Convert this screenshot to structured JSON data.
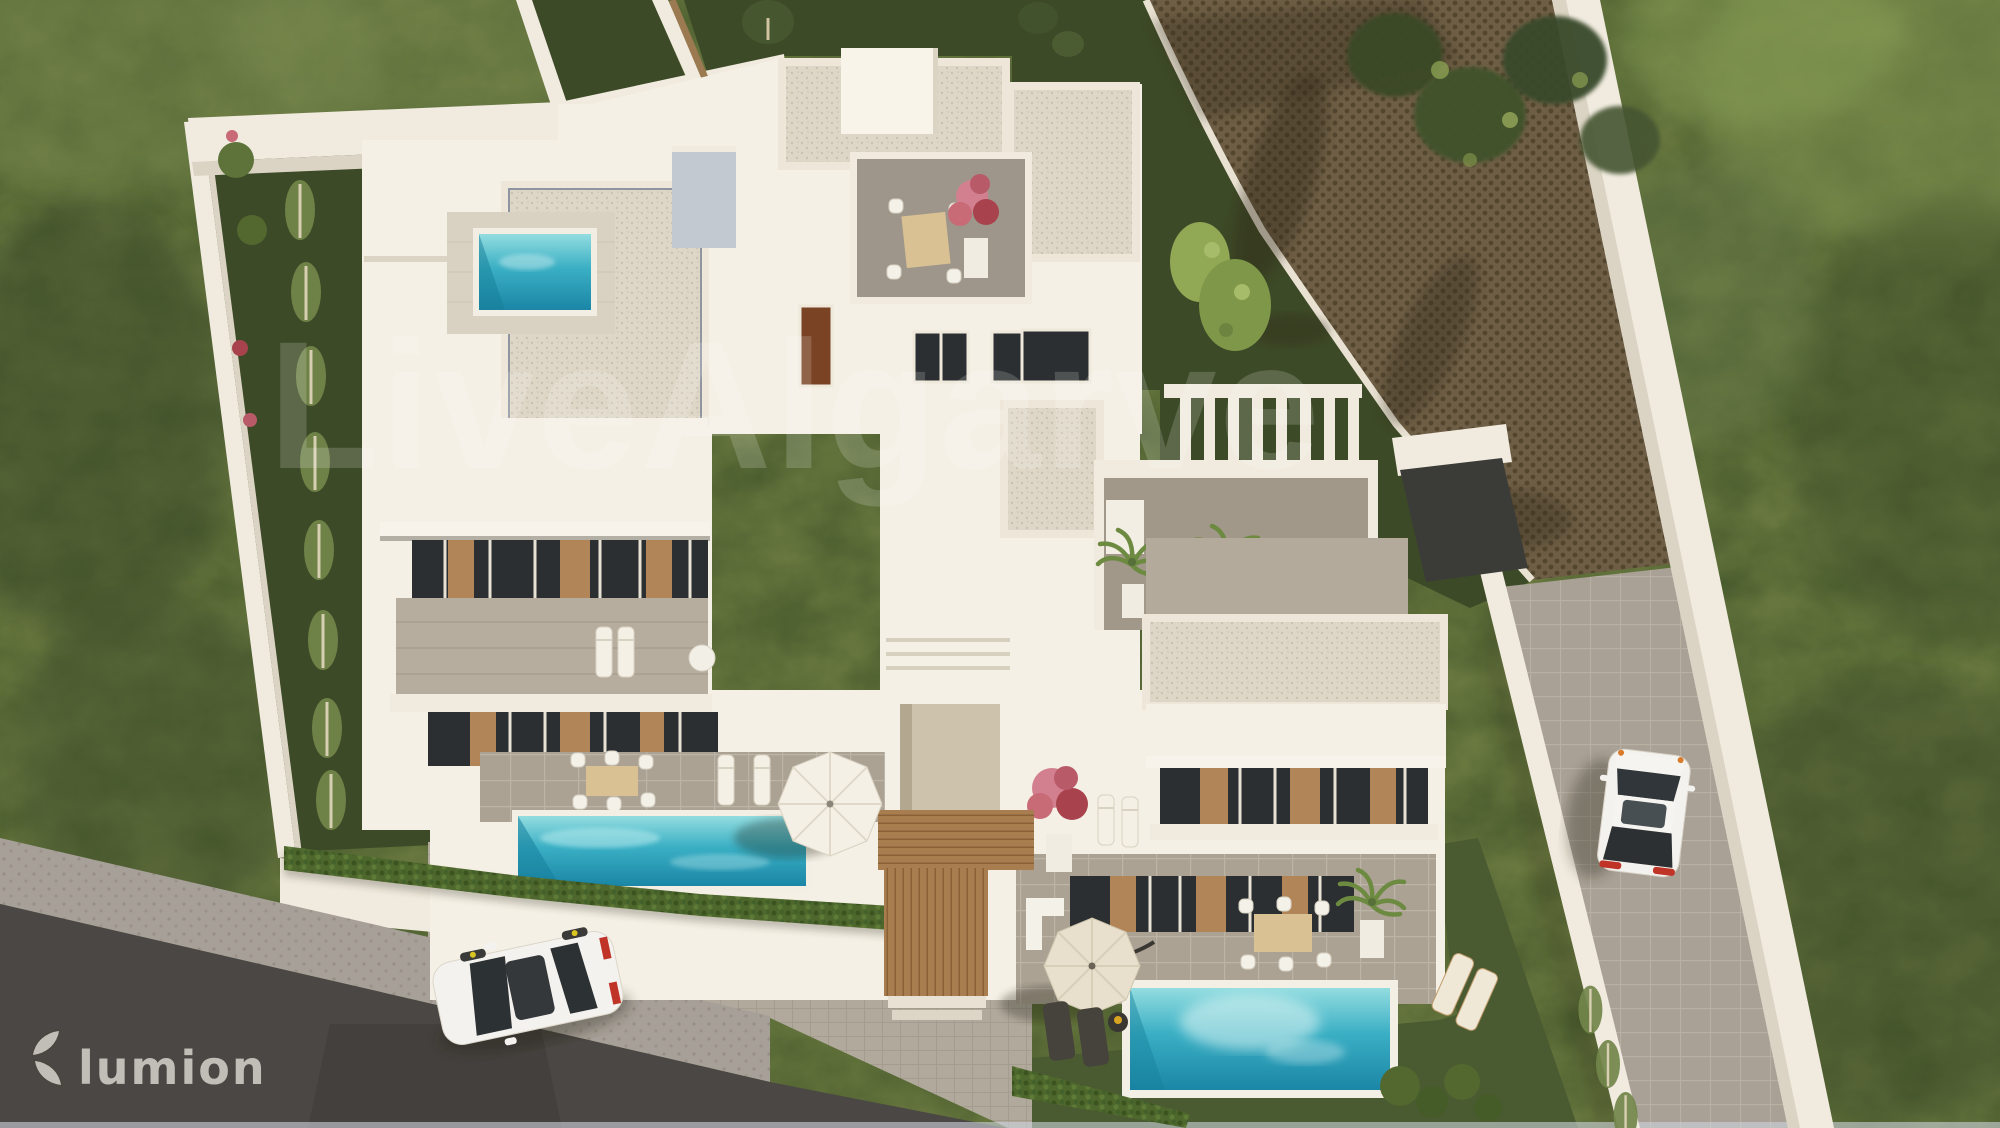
{
  "scene": {
    "type": "3d-aerial-architectural-render",
    "subject": "Top-down 3D visualization of a modern white villa complex with roof terraces, three turquoise pools, cobbled driveways, gardens and a street",
    "watermark_text": "LiveAlgarve",
    "logo_text": "lumion",
    "objects": {
      "villas": 3,
      "swimming_pools": 3,
      "cars": 2,
      "roof_terraces": 2,
      "sun_umbrellas": 2,
      "dining_sets": 4,
      "entrance_pergola": "wooden slatted walkway",
      "street": "dark asphalt road with cobbled sidewalk (bottom left)",
      "driveways": [
        "brown cobblestone court (top right)",
        "grey paved side lane (right)"
      ]
    }
  },
  "palette": {
    "wall": "#f1ebdf",
    "wallShadow": "#dbd4c4",
    "facade": "#f5f0e5",
    "lawnDark": "#3d4a27",
    "lawnMid": "#4a5a31",
    "vegWild": "#56663e",
    "road": "#4b4744",
    "sidewalk": "#a7a098",
    "plaza": "#b0a99c",
    "cobbleBrown": "#6e5e45",
    "terrace": "#a29889",
    "terraceB": "#9e968a",
    "glass": "#2b2f31",
    "wood": "#b18557",
    "roofSpeckle": "#ded6c6",
    "poolLight": "#93dde0",
    "poolMid": "#3aafc4",
    "poolDeep": "#1b86a6",
    "hedge": "#4d672c",
    "flowerPink": "#d2808f",
    "flowerRed": "#a8434e",
    "carWhite": "#f4f2ee",
    "watermark": "rgba(255,255,255,0.17)",
    "logo": "#d6d3cd"
  }
}
